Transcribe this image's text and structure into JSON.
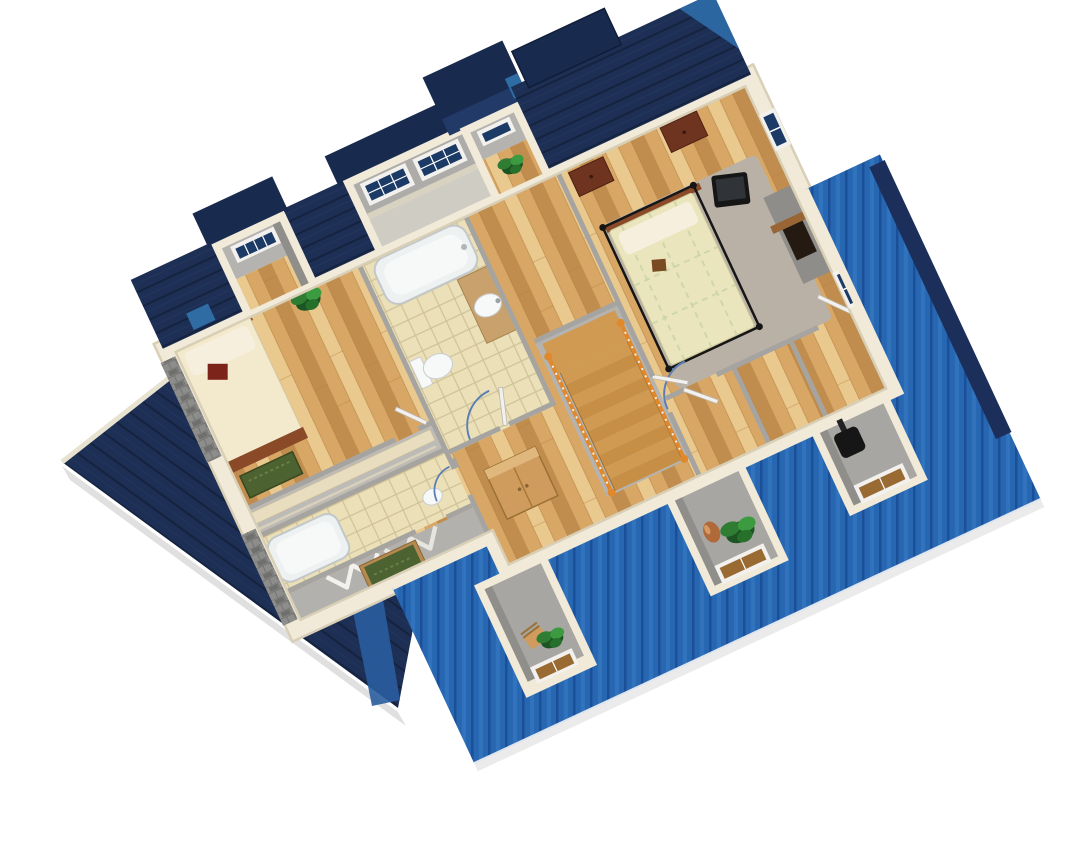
{
  "scene": {
    "kind": "3d-floor-plan-render",
    "view": "aerial-dollhouse-cutaway",
    "floor": "second-floor",
    "rotation_deg": -25,
    "background": "#ffffff"
  },
  "colors": {
    "background": "#ffffff",
    "roof_navy": "#1d2f55",
    "roof_navy_seam": "#15233f",
    "roof_navy_dark": "#182a4e",
    "roof_blue": "#2767b2",
    "roof_blue_seam": "#1b4f98",
    "roof_blue_light": "#3273bd",
    "roof_trim_navy": "#1b2f5a",
    "roof_skylight": "#2e6ca3",
    "wall_cream": "#f1ead8",
    "wall_cream_edge": "#d8cfb6",
    "wall_gray": "#a6a4a0",
    "wall_gray_light": "#bdbbb7",
    "wall_gray_dark": "#908e8a",
    "floor_wood": "#d8a765",
    "floor_wood_light": "#eac98f",
    "floor_wood_dark": "#c08d4e",
    "floor_wood_line": "#b07c3e",
    "floor_tile": "#ece0b9",
    "floor_tile_line": "#cfc298",
    "floor_gray": "#a8a6a2",
    "carpet_gray": "#b9b1a5",
    "fixture_white": "#f7f8f8",
    "fixture_rim": "#c2c7c9",
    "counter_tan": "#c9a16c",
    "stair_wood": "#d09a52",
    "stair_wood_dark": "#c68f45",
    "rail_orange": "#e0882a",
    "metal_silver": "#c7c7c7",
    "bed_cream": "#f3e9cd",
    "bed_yellow": "#ebe5bd",
    "bed_grid": "#c9d4a4",
    "pillow_white": "#f6efdd",
    "cushion_red": "#7c241a",
    "headboard_wood": "#8a4a28",
    "bench_green": "#4c6231",
    "wood_dark": "#6e3420",
    "wood_oak": "#cf9c5e",
    "wood_oak_dark": "#a87838",
    "plant_green": "#2e7d32",
    "plant_dark": "#1c5424",
    "pot_terracotta": "#b06a3a",
    "tv_black": "#161616",
    "stone_gray": "#8d8d8b",
    "stone_dark": "#6f6f6d",
    "glass_navy": "#1c3a66",
    "glass_amber": "#9a6a33",
    "door_white": "#f2f1ee",
    "door_arc": "#5b7fb4",
    "shadow_black": "#000000"
  },
  "structure": {
    "roof_sections": [
      "big-left-navy-roof",
      "back-navy-roof-strips",
      "top-right-navy-roof",
      "front-blue-roof",
      "east-blue-roof",
      "east-navy-gable-trim",
      "skylight-patch"
    ],
    "dormers": [
      "left-bedroom-window-dormer",
      "bathroom-two-window-dormer",
      "hall-top-dormer",
      "front-dormer-chair",
      "front-dormer-vase-plant",
      "front-dormer-stove"
    ],
    "rooms": [
      "left-bedroom",
      "main-bathroom",
      "long-closet",
      "second-bathroom",
      "bifold-closet",
      "hall-landing",
      "master-bedroom",
      "south-bonus-rooms"
    ],
    "fixtures": [
      "bathtub-main",
      "toilet",
      "vanity-sink",
      "bathtub-second",
      "pedestal-sink"
    ],
    "furniture": [
      "bed-left",
      "green-bench",
      "red-cushion",
      "canopy-bed",
      "gray-rug",
      "tv-set",
      "fireplace-media-wall",
      "dresser-1",
      "dresser-2",
      "oak-wardrobe",
      "closet-shelf",
      "bifold-doors",
      "wooden-chair",
      "terracotta-vase",
      "black-stove",
      "potted-plants"
    ],
    "stairs": {
      "treads": 10,
      "rail": "orange-with-white-balusters",
      "direction": "descending-southeast"
    }
  }
}
